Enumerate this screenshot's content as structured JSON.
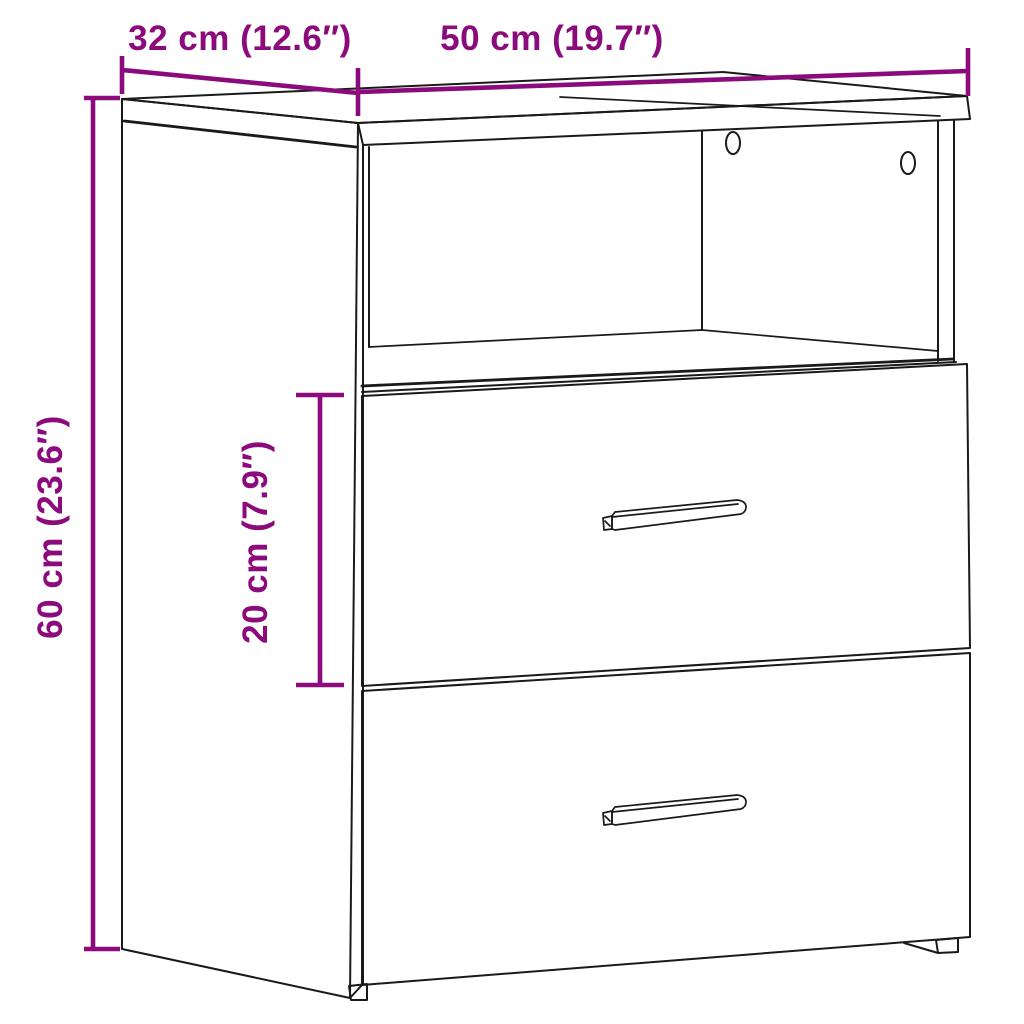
{
  "diagram": {
    "subject": "Bedside cabinet with open compartment and two drawers — dimension drawing",
    "background_color": "#ffffff",
    "line_color": "#1a1a1a",
    "accent_color": "#8C0B7C",
    "dimensions": {
      "depth": {
        "label": "32 cm (12.6″)",
        "cm": 32,
        "inches": 12.6
      },
      "width": {
        "label": "50 cm (19.7″)",
        "cm": 50,
        "inches": 19.7
      },
      "height": {
        "label": "60 cm (23.6″)",
        "cm": 60,
        "inches": 23.6
      },
      "drawer_height": {
        "label": "20 cm (7.9″)",
        "cm": 20,
        "inches": 7.9
      }
    }
  }
}
